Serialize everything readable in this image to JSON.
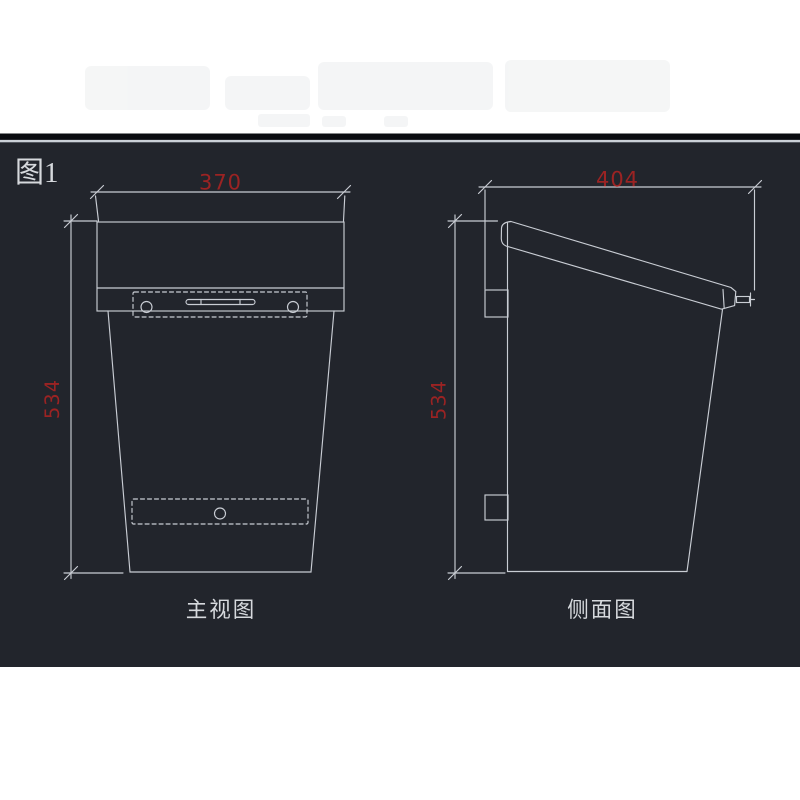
{
  "figure_label": "图1",
  "panel": {
    "page_background": "#ffffff",
    "background": "#22252c",
    "top_border_dark": "#0a0c10",
    "top_border_light": "#cbd0d7"
  },
  "drawing": {
    "line_color": "#c9cdd4",
    "dimension_color": "#9b2323",
    "text_color": "#d6d9dd",
    "front_view": {
      "label": "主视图",
      "width_dim": "370",
      "height_dim": "534"
    },
    "side_view": {
      "label": "侧面图",
      "depth_dim": "404",
      "height_dim": "534"
    }
  }
}
